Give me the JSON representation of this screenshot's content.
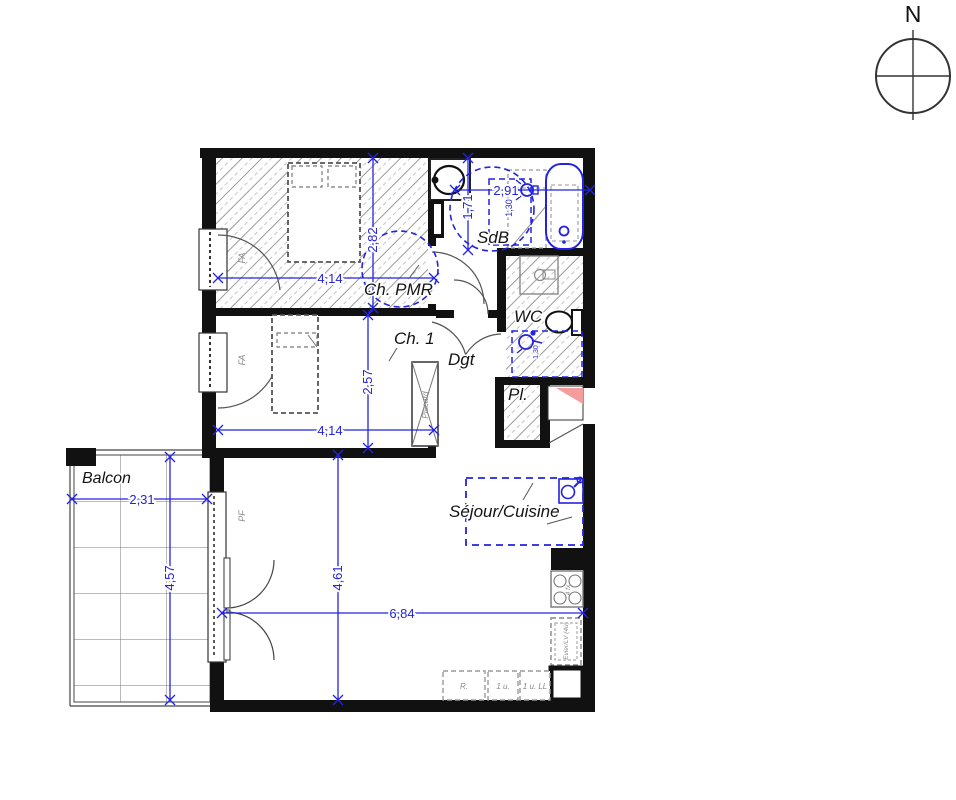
{
  "plan": {
    "north": "N",
    "rooms": {
      "ch_pmr": "Ch. PMR",
      "ch1": "Ch. 1",
      "sdb": "SdB",
      "wc": "WC",
      "dgt": "Dgt",
      "pl": "Pl.",
      "sejour": "Séjour/Cuisine",
      "balcon": "Balcon"
    },
    "dims": {
      "ch_pmr_w": "4,14",
      "ch_pmr_h": "2,82",
      "ch1_w": "4,14",
      "ch1_h": "2,57",
      "sdb_w": "2,91",
      "sdb_h": "1,71",
      "sdb_zone": "1,30",
      "wc_zone": "1,30",
      "sejour_w": "6,84",
      "sejour_h": "4,61",
      "balcon_w": "2,31",
      "balcon_h": "4,57"
    },
    "labels": {
      "window_pmr": "FA",
      "window_ch1": "FA",
      "balcony_door": "PF",
      "closet": "Placard",
      "fridge": "R.",
      "unit_1": "1 u.",
      "unit_2": "1 u. LL",
      "sink_unit": "Evier/LV (4u)",
      "hob": "4 fx"
    },
    "colors": {
      "dimension_blue": "#2323e0",
      "entry_red": "#f59c9c",
      "wall": "#111111",
      "hatch": "#9a9a9a"
    }
  }
}
